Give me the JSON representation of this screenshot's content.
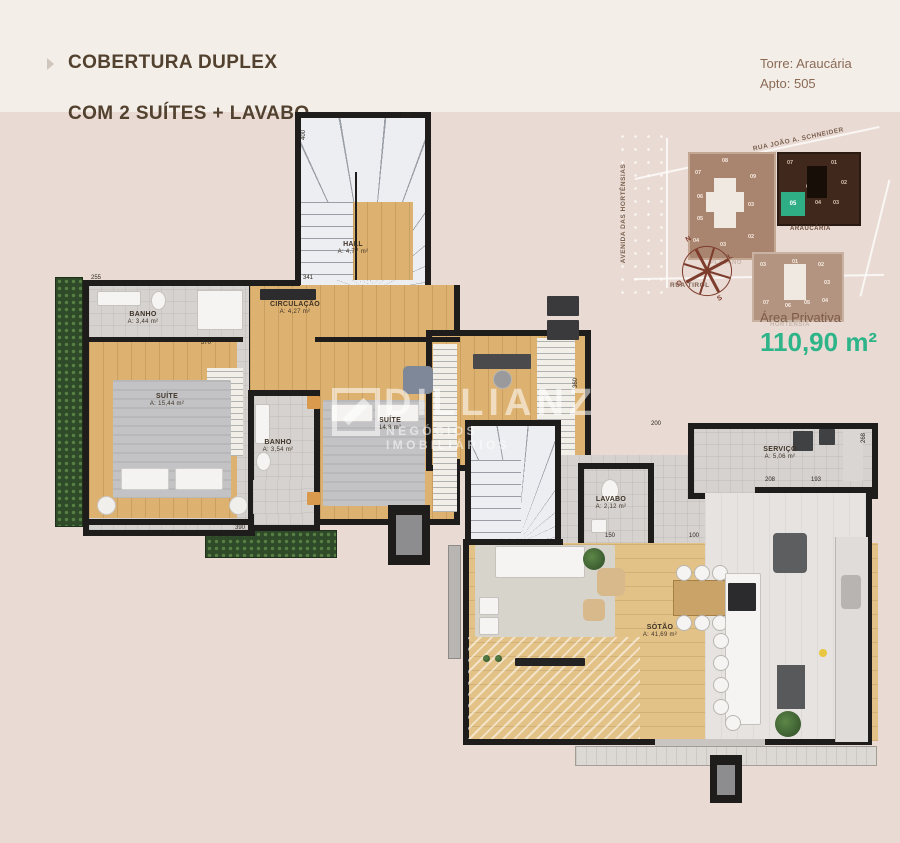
{
  "meta": {
    "background": "#e9dbd4",
    "header_background": "#f3eee8",
    "accent_green": "#2db489",
    "wall_color": "#1e1d1b",
    "highlight_unit_color": "#2fae85"
  },
  "header": {
    "title_line1": "COBERTURA DUPLEX",
    "title_line2": "COM 2 SUÍTES + LAVABO",
    "tower": "Torre: Araucária",
    "apto": "Apto: 505"
  },
  "site_map": {
    "street_top": "RUA JOÃO A. SCHNEIDER",
    "street_left": "AVENIDA DAS HORTÊNSIAS",
    "street_bottom": "RUA TIROL",
    "buildings": [
      {
        "name": "PLÁTANO",
        "units": [
          "08",
          "07",
          "09",
          "06",
          "05",
          "03",
          "04",
          "03",
          "02"
        ]
      },
      {
        "name": "ARAUCÁRIA",
        "highlighted_unit": "05",
        "units": [
          "07",
          "01",
          "02",
          "06",
          "04",
          "03",
          "05"
        ]
      },
      {
        "name": "HORTÊNSIA",
        "units": [
          "03",
          "01",
          "02",
          "03",
          "07",
          "06",
          "05",
          "04"
        ]
      }
    ],
    "compass": {
      "n": "N",
      "e": "L",
      "s": "S",
      "w": "O"
    }
  },
  "area_privativa": {
    "label": "Área Privativa",
    "value": "110,90 m²"
  },
  "upper_floor": {
    "rooms": {
      "hall": {
        "name": "HALL",
        "area": "A: 4,77 m²"
      },
      "circulacao": {
        "name": "CIRCULAÇÃO",
        "area": "A: 4,27 m²"
      },
      "banho1": {
        "name": "BANHO",
        "area": "A: 3,44 m²"
      },
      "suite1": {
        "name": "SUÍTE",
        "area": "A: 15,44 m²"
      },
      "banho2": {
        "name": "BANHO",
        "area": "A: 3,54 m²"
      },
      "suite2": {
        "name": "SUÍTE",
        "area": "14,8 m²"
      }
    },
    "dims": {
      "d1": "400",
      "d2": "200",
      "d3": "255",
      "d4": "341",
      "d5": "370",
      "d6": "390",
      "d7": "360"
    }
  },
  "lower_floor": {
    "rooms": {
      "servico": {
        "name": "SERVIÇO",
        "area": "A: 5,06 m²"
      },
      "lavabo": {
        "name": "LAVABO",
        "area": "A: 2,12 m²"
      },
      "sotao": {
        "name": "SÓTÃO",
        "area": "A: 41,69 m²"
      }
    },
    "dims": {
      "d1": "200",
      "d2": "268",
      "d3": "208",
      "d4": "193",
      "d5": "100",
      "d6": "150"
    }
  },
  "watermark": {
    "name": "DILLIANZ",
    "tagline": "NEGÓCIOS IMOBILIÁRIOS"
  }
}
